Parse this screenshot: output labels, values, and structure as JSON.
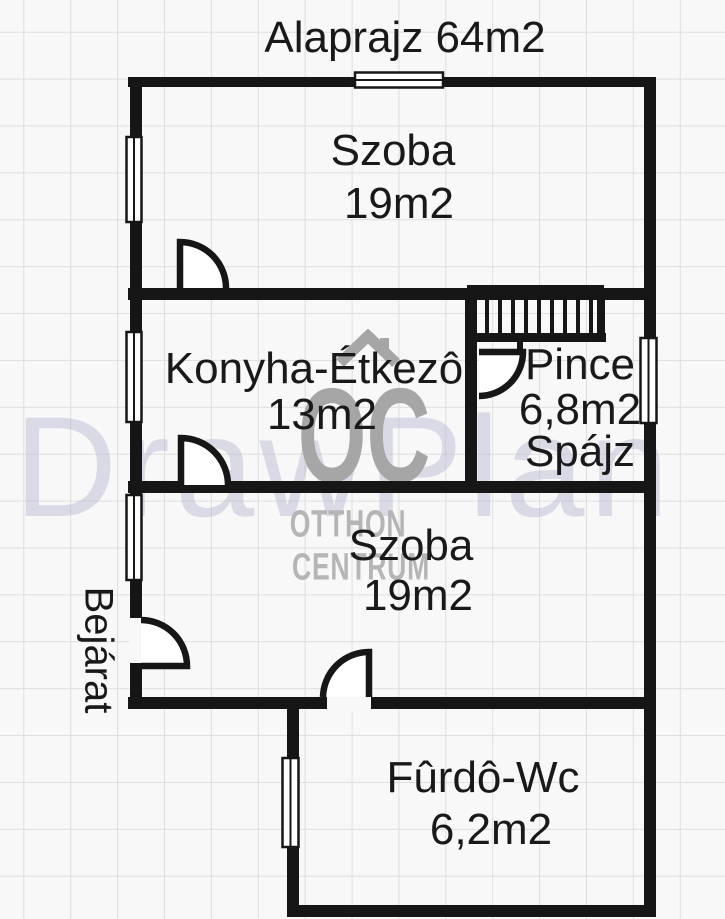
{
  "title": "Alaprajz 64m2",
  "rooms": {
    "szoba_top": {
      "name": "Szoba",
      "area": "19m2"
    },
    "konyha": {
      "name": "Konyha-Étkezô",
      "area": "13m2"
    },
    "pince": {
      "name": "Pince",
      "area": "6,8m2",
      "note": "Spájz"
    },
    "szoba_bottom": {
      "name": "Szoba",
      "area": "19m2"
    },
    "furdo": {
      "name": "Fûrdô-Wc",
      "area": "6,2m2"
    }
  },
  "entrance_label": "Bejárat",
  "watermarks": {
    "drawplan": "DrawPlan",
    "logo_initials": "OC",
    "logo_line1": "OTTHON",
    "logo_line2": "CENTRUM"
  },
  "colors": {
    "background": "#f8f8f8",
    "grid_line": "#dedede",
    "wall": "#161616",
    "text": "#191919",
    "watermark_gray": "#a6a6a6",
    "watermark_light_gray": "#b5b5b5",
    "watermark_lavender": "#b0b0ce"
  }
}
